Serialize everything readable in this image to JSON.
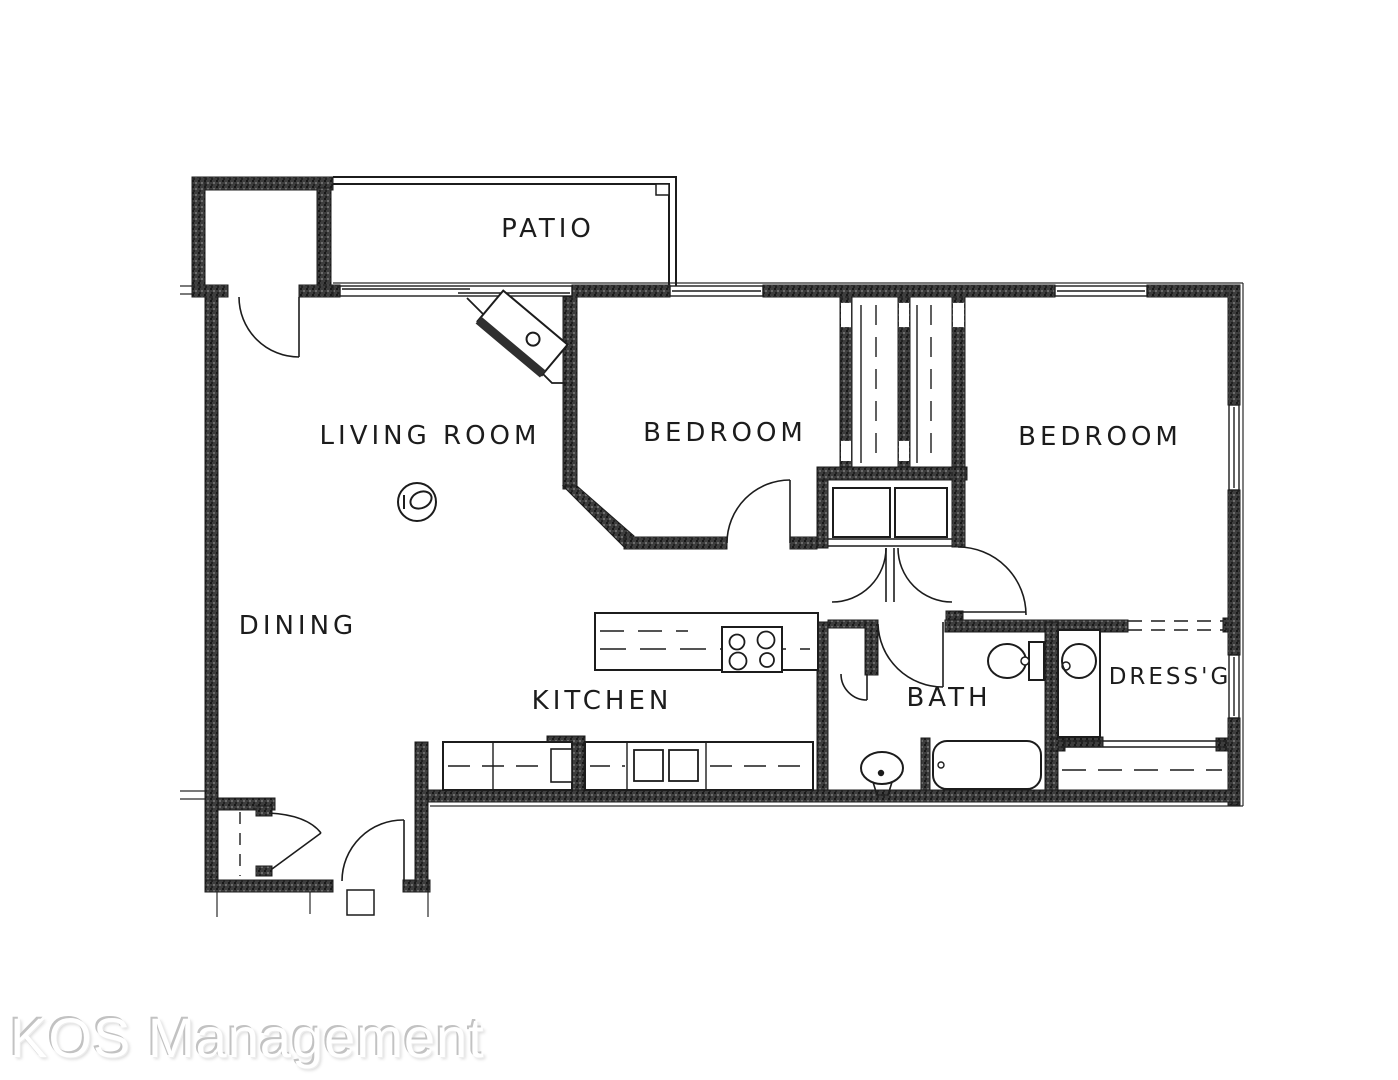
{
  "document": {
    "type": "apartment-floor-plan"
  },
  "plan": {
    "rooms": [
      {
        "id": "patio",
        "label": "PATIO"
      },
      {
        "id": "living-room",
        "label": "LIVING ROOM"
      },
      {
        "id": "bedroom-1",
        "label": "BEDROOM"
      },
      {
        "id": "bedroom-2",
        "label": "BEDROOM"
      },
      {
        "id": "dining",
        "label": "DINING"
      },
      {
        "id": "kitchen",
        "label": "KITCHEN"
      },
      {
        "id": "bath",
        "label": "BATH"
      },
      {
        "id": "dressing",
        "label": "DRESS'G"
      }
    ],
    "fixtures": [
      "patio-storage-closet",
      "corner-fireplace",
      "ceiling-light",
      "range-cooktop",
      "double-kitchen-sink",
      "closet-shelves",
      "wardrobe-closets",
      "toilet",
      "pedestal-sink",
      "bathtub",
      "vanity-sink",
      "entry-closet",
      "front-door",
      "entry-step"
    ]
  },
  "watermark": {
    "text": "KOS Management"
  },
  "colors": {
    "background": "#ffffff",
    "line": "#1c1c1c",
    "wall": "#3d3d3d",
    "watermark_text": "#ffffff",
    "watermark_shadow": "#c2c2c2"
  }
}
